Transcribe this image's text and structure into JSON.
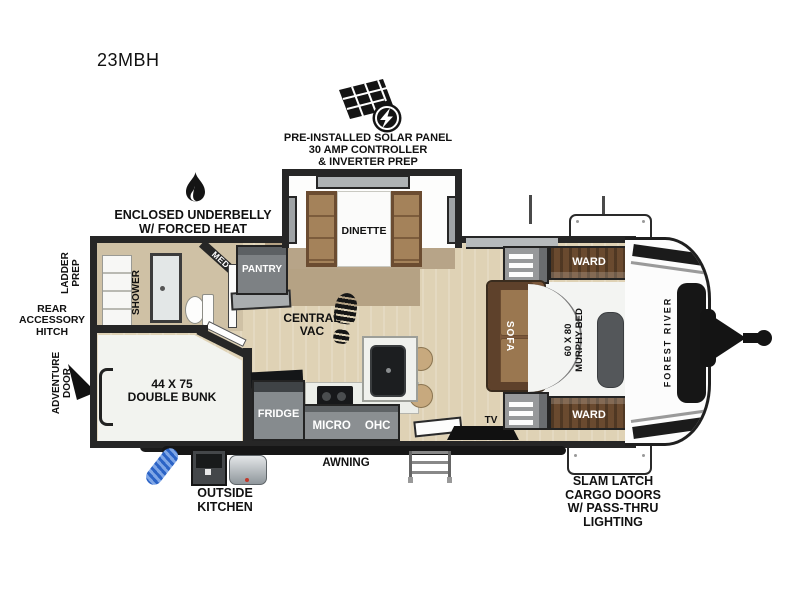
{
  "model": "23MBH",
  "brand": "FOREST RIVER",
  "callouts": {
    "solar": {
      "l1": "PRE-INSTALLED SOLAR PANEL",
      "l2": "30 AMP CONTROLLER",
      "l3": "& INVERTER PREP"
    },
    "underbelly": {
      "l1": "ENCLOSED UNDERBELLY",
      "l2": "W/ FORCED HEAT"
    },
    "ladder": {
      "l1": "LADDER",
      "l2": "PREP"
    },
    "rear_hitch": {
      "l1": "REAR",
      "l2": "ACCESSORY",
      "l3": "HITCH"
    },
    "adventure": {
      "l1": "ADVENTURE",
      "l2": "DOOR"
    },
    "outside_kitchen": {
      "l1": "OUTSIDE",
      "l2": "KITCHEN"
    },
    "cargo": {
      "l1": "SLAM LATCH",
      "l2": "CARGO DOORS",
      "l3": "W/ PASS-THRU",
      "l4": "LIGHTING"
    },
    "awning": "AWNING"
  },
  "rooms": {
    "dinette": "DINETTE",
    "pantry": "PANTRY",
    "med": "MED",
    "shower": "SHOWER",
    "central_vac": {
      "l1": "CENTRAL",
      "l2": "VAC"
    },
    "bunk": {
      "l1": "44 X 75",
      "l2": "DOUBLE BUNK"
    },
    "fridge": "FRIDGE",
    "micro": "MICRO",
    "ohc": "OHC",
    "tv": "TV",
    "sofa": "SOFA",
    "murphy": {
      "l1": "60 X 80",
      "l2": "MURPHY BED"
    },
    "ward_top": "WARD",
    "ward_bottom": "WARD"
  },
  "colors": {
    "wall": "#262626",
    "floor": "#dfd2b5",
    "rug": "#b5a284",
    "wood": "#6a4a2f",
    "cabinet_gray": "#8b8f92",
    "bed_white": "#f3f4f2",
    "hose_blue": "#2b63c6"
  }
}
